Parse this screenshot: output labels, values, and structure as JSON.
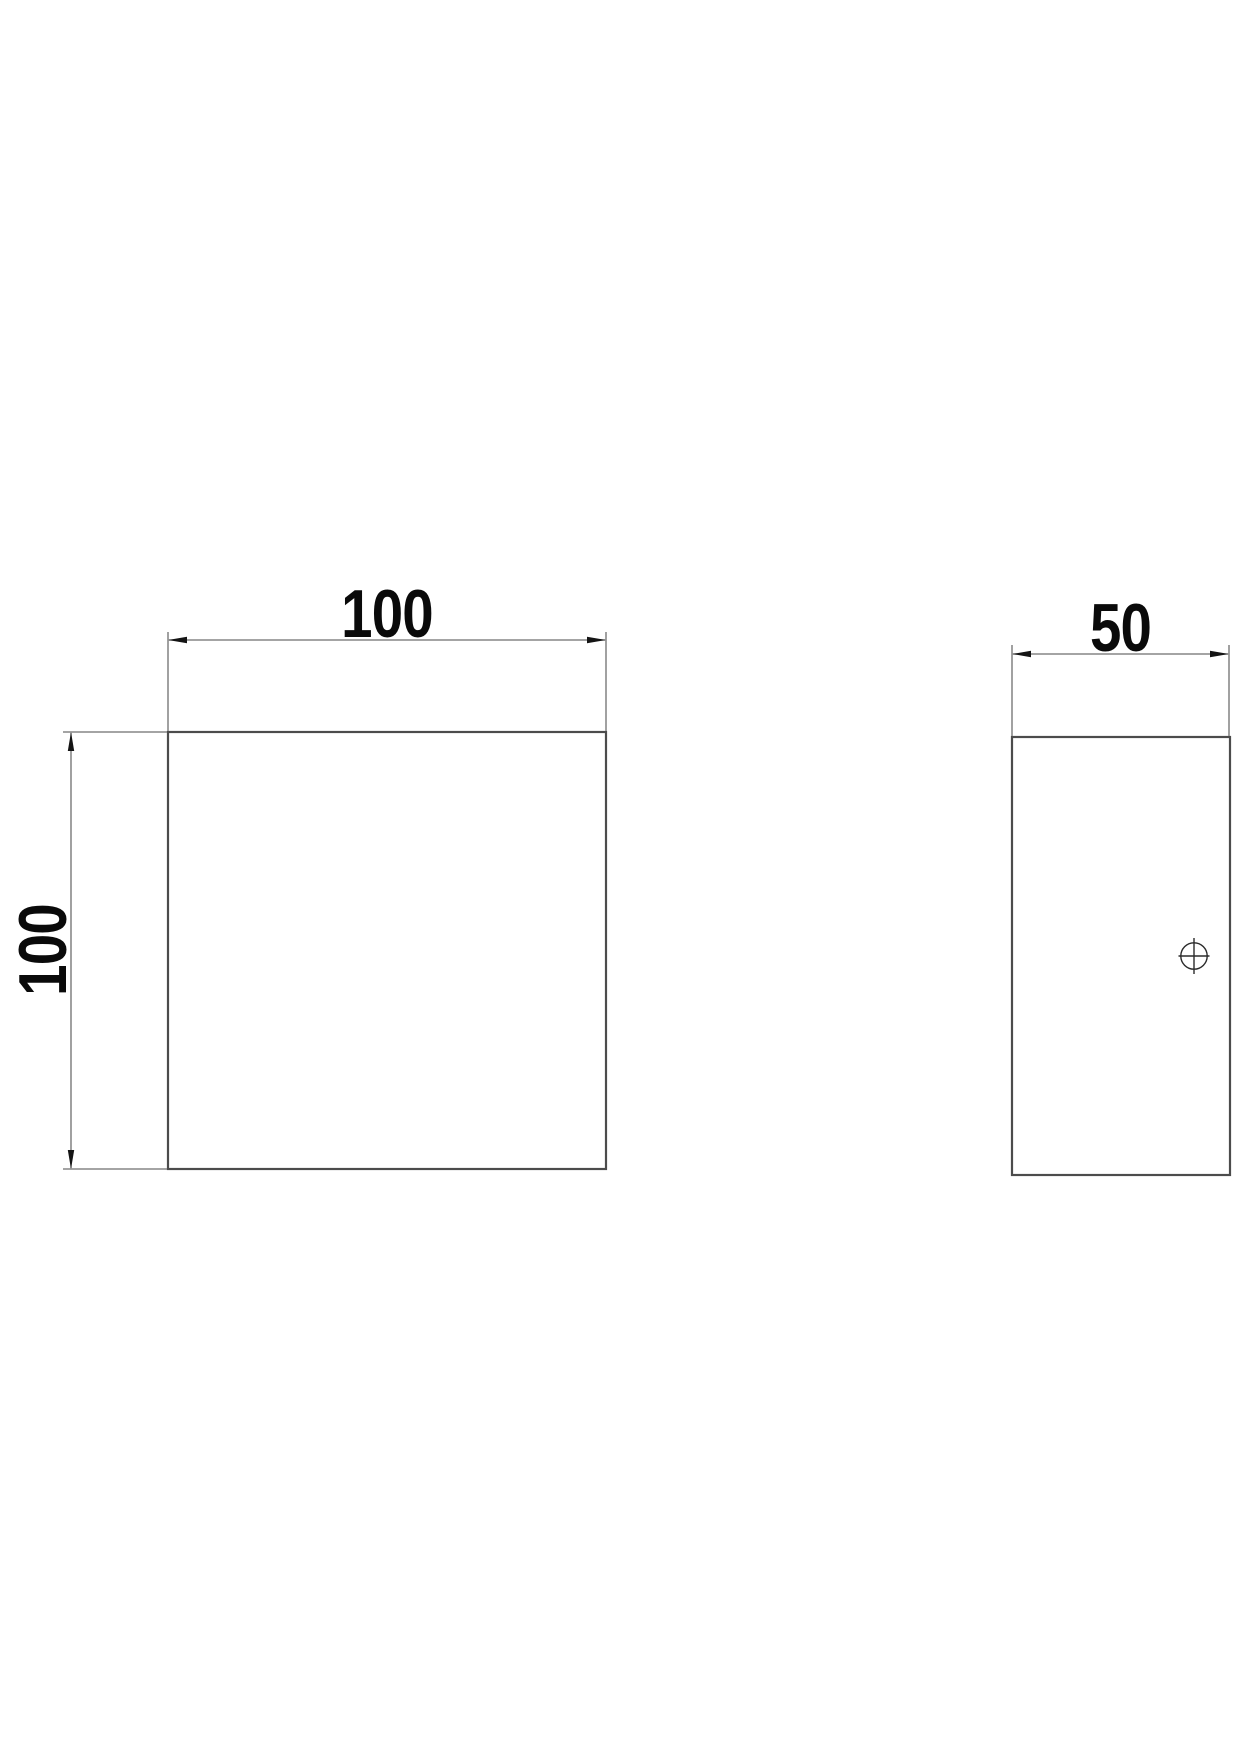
{
  "drawing": {
    "front_view": {
      "width_dim": {
        "label": "100"
      },
      "height_dim": {
        "label": "100"
      }
    },
    "side_view": {
      "width_dim": {
        "label": "50"
      },
      "hole_marker": {
        "symbol": "crosshair-circle"
      }
    },
    "colors": {
      "background": "#ffffff",
      "outline": "#4c4c4c",
      "dimension_line": "#6e6e6e",
      "arrow": "#141414",
      "text": "#0a0a0a",
      "hole_marker": "#2b2b2b"
    }
  }
}
